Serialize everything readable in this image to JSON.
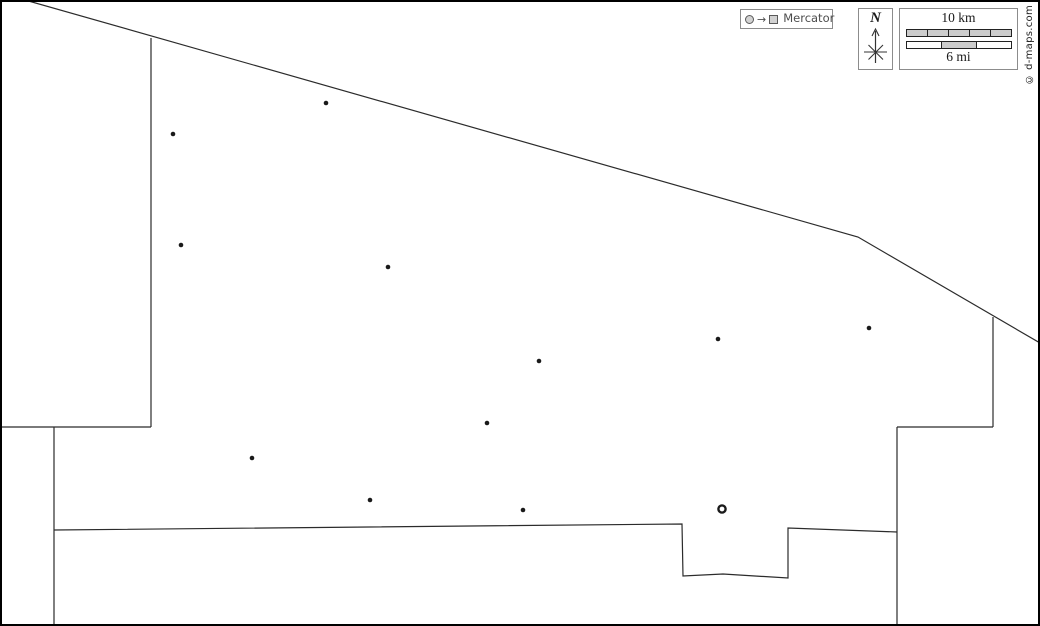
{
  "canvas": {
    "width": 1040,
    "height": 626,
    "background_color": "#ffffff",
    "frame_color": "#000000",
    "line_color": "#2b2b2b"
  },
  "map": {
    "boundaries": [
      {
        "name": "north-diagonal",
        "points": [
          [
            25,
            0
          ],
          [
            858,
            237
          ],
          [
            1040,
            343
          ]
        ]
      },
      {
        "name": "west-vertical",
        "points": [
          [
            151,
            38
          ],
          [
            151,
            427
          ]
        ]
      },
      {
        "name": "west-horizontal",
        "points": [
          [
            0,
            427
          ],
          [
            151,
            427
          ]
        ]
      },
      {
        "name": "southwest-vertical",
        "points": [
          [
            54,
            427
          ],
          [
            54,
            626
          ]
        ]
      },
      {
        "name": "south-with-notch",
        "points": [
          [
            54,
            530
          ],
          [
            682,
            524
          ],
          [
            683,
            576
          ],
          [
            723,
            574
          ],
          [
            788,
            578
          ],
          [
            788,
            528
          ],
          [
            897,
            532
          ]
        ]
      },
      {
        "name": "southeast-vertical",
        "points": [
          [
            897,
            427
          ],
          [
            897,
            626
          ]
        ]
      },
      {
        "name": "east-horizontal",
        "points": [
          [
            897,
            427
          ],
          [
            993,
            427
          ]
        ]
      },
      {
        "name": "east-vertical",
        "points": [
          [
            993,
            317
          ],
          [
            993,
            427
          ]
        ]
      }
    ],
    "city_markers": [
      {
        "x": 326,
        "y": 103
      },
      {
        "x": 173,
        "y": 134
      },
      {
        "x": 181,
        "y": 245
      },
      {
        "x": 388,
        "y": 267
      },
      {
        "x": 869,
        "y": 328
      },
      {
        "x": 718,
        "y": 339
      },
      {
        "x": 539,
        "y": 361
      },
      {
        "x": 487,
        "y": 423
      },
      {
        "x": 252,
        "y": 458
      },
      {
        "x": 370,
        "y": 500
      },
      {
        "x": 523,
        "y": 510
      }
    ],
    "capital_marker": {
      "x": 722,
      "y": 509
    }
  },
  "legend": {
    "projection": {
      "label": "Mercator",
      "arrow_glyph": "→"
    },
    "compass": {
      "north_label": "N"
    },
    "scale": {
      "km_label": "10 km",
      "mi_label": "6 mi",
      "km_segment_fills": [
        "#cccccc",
        "#cccccc",
        "#cccccc",
        "#cccccc",
        "#cccccc"
      ],
      "mi_segment_fills": [
        "#ffffff",
        "#cccccc",
        "#ffffff"
      ]
    },
    "copyright": "© d-maps.com"
  }
}
